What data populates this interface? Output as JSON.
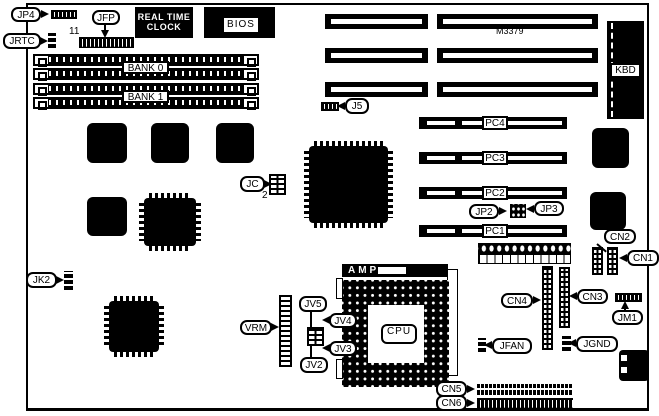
{
  "colors": {
    "ink": "#000000",
    "paper": "#ffffff"
  },
  "labels": {
    "jp4": "JP4",
    "jrtc": "JRTC",
    "jfp": "JFP",
    "jfp_pin": "11",
    "rtc_line1": "REAL TIME",
    "rtc_line2": "CLOCK",
    "bios": "BIOS",
    "bank0": "BANK 0",
    "bank1": "BANK 1",
    "m3379": "M3379",
    "kbd": "KBD",
    "j5": "J5",
    "pc4": "PC4",
    "pc3": "PC3",
    "pc2": "PC2",
    "pc1": "PC1",
    "jp2": "JP2",
    "jp3": "JP3",
    "jc": "JC",
    "jc_pin": "2",
    "jk2": "JK2",
    "cn1": "CN1",
    "cn2": "CN2",
    "cn3": "CN3",
    "cn4": "CN4",
    "cn5": "CN5",
    "cn6": "CN6",
    "jm1": "JM1",
    "vrm": "VRM",
    "jv2": "JV2",
    "jv3": "JV3",
    "jv4": "JV4",
    "jv5": "JV5",
    "amp": "AMP",
    "cpu": "CPU",
    "jfan": "JFAN",
    "jgnd": "JGND"
  }
}
